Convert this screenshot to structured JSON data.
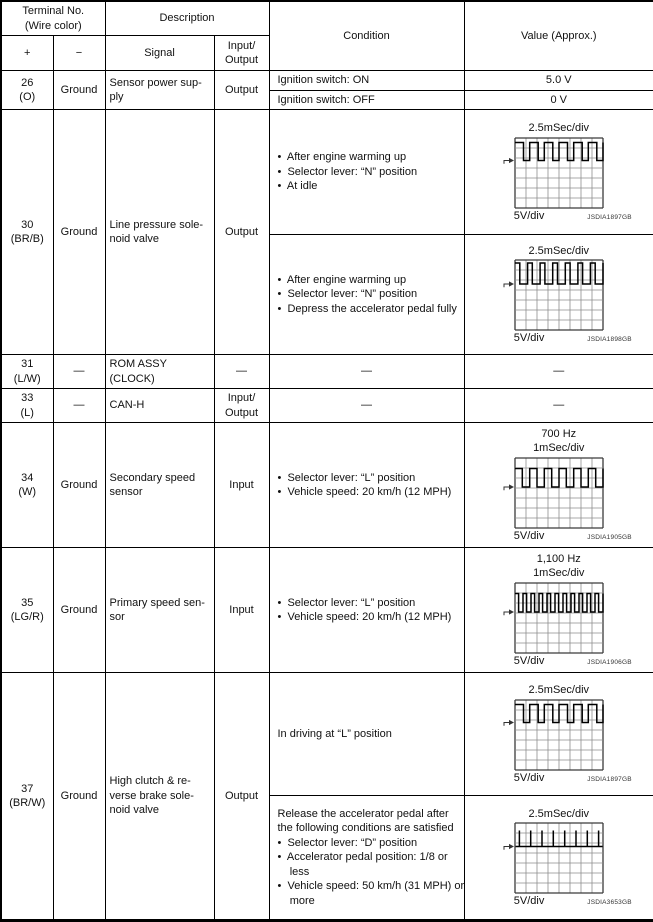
{
  "header": {
    "terminal": "Terminal No.\n(Wire color)",
    "description": "Description",
    "condition": "Condition",
    "value": "Value (Approx.)",
    "plus": "+",
    "minus": "−",
    "signal": "Signal",
    "io": "Input/\nOutput"
  },
  "rows": {
    "r26": {
      "terminal": "26\n(O)",
      "ground": "Ground",
      "signal": "Sensor power sup-\nply",
      "io": "Output",
      "cond_on": "Ignition switch: ON",
      "val_on": "5.0 V",
      "cond_off": "Ignition switch: OFF",
      "val_off": "0 V"
    },
    "r30": {
      "terminal": "30\n(BR/B)",
      "ground": "Ground",
      "signal": "Line pressure sole-\nnoid valve",
      "io": "Output",
      "cond1": "•  After engine warming up\n•  Selector lever: “N” position\n•  At idle",
      "cond2": "•  After engine warming up\n•  Selector lever: “N” position\n•  Depress the accelerator pedal fully"
    },
    "r31": {
      "terminal": "31\n(L/W)",
      "ground": "—",
      "signal": "ROM ASSY\n(CLOCK)",
      "io": "—",
      "cond": "—",
      "val": "—"
    },
    "r33": {
      "terminal": "33\n(L)",
      "ground": "—",
      "signal": "CAN-H",
      "io": "Input/\nOutput",
      "cond": "—",
      "val": "—"
    },
    "r34": {
      "terminal": "34\n(W)",
      "ground": "Ground",
      "signal": "Secondary speed\nsensor",
      "io": "Input",
      "cond": "•  Selector lever: “L” position\n•  Vehicle speed: 20 km/h (12 MPH)"
    },
    "r35": {
      "terminal": "35\n(LG/R)",
      "ground": "Ground",
      "signal": "Primary speed sen-\nsor",
      "io": "Input",
      "cond": "•  Selector lever: “L” position\n•  Vehicle speed: 20 km/h (12 MPH)"
    },
    "r37": {
      "terminal": "37\n(BR/W)",
      "ground": "Ground",
      "signal": "High clutch & re-\nverse brake sole-\nnoid valve",
      "io": "Output",
      "cond1": "In driving at “L” position",
      "cond2": "Release the accelerator pedal after\nthe following conditions are satisfied\n•  Selector lever: “D” position\n•  Accelerator pedal position: 1/8 or\n    less\n•  Vehicle speed: 50 km/h (31 MPH) or\n    more"
    }
  },
  "scopes": {
    "s30a": {
      "freq": "",
      "time_div": "2.5mSec/div",
      "volt_div": "5V/div",
      "code": "JSDIA1897GB",
      "grid": {
        "cols": 8,
        "rows": 7
      },
      "wave": {
        "type": "pwm",
        "cycles": 6,
        "duty_high": 0.58,
        "y_high": 0.45,
        "y_low": 2.25,
        "arrow_y": 2.25
      }
    },
    "s30b": {
      "freq": "",
      "time_div": "2.5mSec/div",
      "volt_div": "5V/div",
      "code": "JSDIA1898GB",
      "grid": {
        "cols": 8,
        "rows": 7
      },
      "wave": {
        "type": "pwm",
        "cycles": 7,
        "duty_high": 0.38,
        "y_high": 0.3,
        "y_low": 2.4,
        "arrow_y": 2.4
      }
    },
    "s34": {
      "freq": "700 Hz",
      "time_div": "1mSec/div",
      "volt_div": "5V/div",
      "code": "JSDIA1905GB",
      "grid": {
        "cols": 8,
        "rows": 7
      },
      "wave": {
        "type": "pwm",
        "cycles": 6,
        "duty_high": 0.5,
        "y_high": 1.05,
        "y_low": 2.9,
        "arrow_y": 2.9
      }
    },
    "s35": {
      "freq": "1,100 Hz",
      "time_div": "1mSec/div",
      "volt_div": "5V/div",
      "code": "JSDIA1906GB",
      "grid": {
        "cols": 8,
        "rows": 7
      },
      "wave": {
        "type": "pwm",
        "cycles": 11,
        "duty_high": 0.45,
        "y_high": 1.05,
        "y_low": 2.9,
        "arrow_y": 2.9
      }
    },
    "s37a": {
      "freq": "",
      "time_div": "2.5mSec/div",
      "volt_div": "5V/div",
      "code": "JSDIA1897GB",
      "grid": {
        "cols": 8,
        "rows": 7
      },
      "wave": {
        "type": "pwm",
        "cycles": 6,
        "duty_high": 0.58,
        "y_high": 0.45,
        "y_low": 2.25,
        "arrow_y": 2.25
      }
    },
    "s37b": {
      "freq": "",
      "time_div": "2.5mSec/div",
      "volt_div": "5V/div",
      "code": "JSDIA3653GB",
      "grid": {
        "cols": 8,
        "rows": 7
      },
      "wave": {
        "type": "spikes",
        "count": 8,
        "y_base": 2.35,
        "y_peak": 0.75,
        "arrow_y": 2.35
      }
    }
  }
}
